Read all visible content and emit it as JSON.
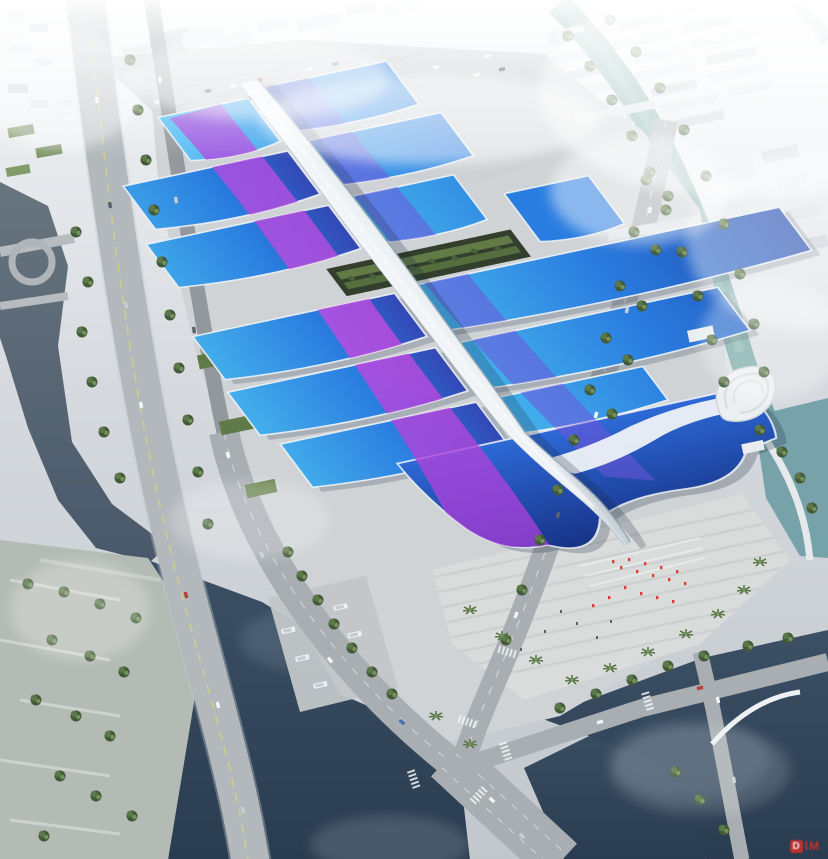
{
  "scene": {
    "kind": "aerial-architectural-rendering",
    "subject": "exhibition-convention-center-complex"
  },
  "watermark": {
    "icon_letter": "D",
    "text": "IM"
  },
  "colors": {
    "fog": "#f4f7f9",
    "city": "#dbe1e6",
    "cityShade": "#c3cbd2",
    "ground": "#cfd3d6",
    "plaza": "#dadcdb",
    "road": "#a9aeb2",
    "roadDark": "#93989c",
    "laneYellow": "#d6d67a",
    "riverWater": "#5d6b78",
    "darkWater": "#33455a",
    "canalWater": "#74a5a4",
    "tealWater": "#6f9da6",
    "treeDark": "#42593a",
    "treeMid": "#5b7848",
    "treeLight": "#7d9c5f",
    "lawn": "#8aa468",
    "roofAzure": "#45b2ec",
    "roofBlue": "#2a7de0",
    "roofDeep": "#1e47ac",
    "roofIndigo": "#3348b4",
    "roofNavyTop": "#2e6ad8",
    "roofNavyBot": "#142c7c",
    "swooshMagenta": "#bf4be0",
    "swooshViolet": "#6f55d8",
    "spineWhite": "#eaeff3",
    "spineShade": "#b9c4cc",
    "trimWhite": "#eef3f6",
    "peopleRed": "#d84038",
    "watermarkRed": "#d43028"
  }
}
